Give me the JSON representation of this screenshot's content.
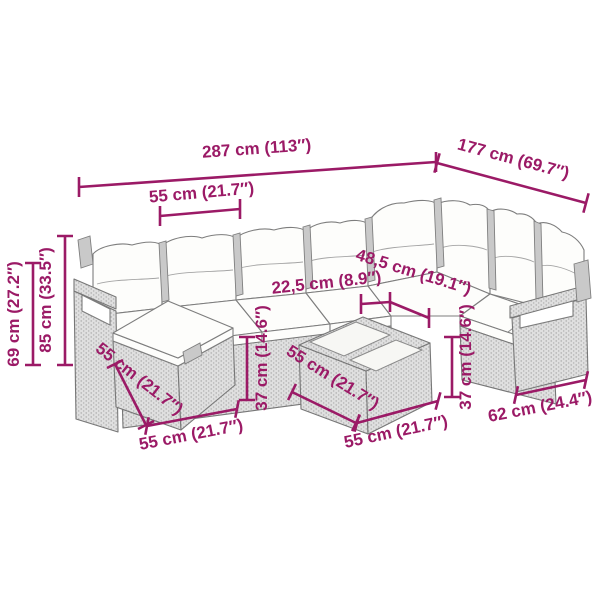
{
  "page": {
    "background": "#ffffff"
  },
  "colors": {
    "dimension_accent": "#9B1A66",
    "drawing_outline": "#777777",
    "rattan_fill": "#dfdfdf",
    "cushion_fill": "#fdfdfb"
  },
  "diagram": {
    "labels": {
      "total_width": "287 cm (113″)",
      "total_depth": "177 cm (69.7″)",
      "seat_module_width": "55 cm (21.7″)",
      "armrest_height": "69 cm (27.2″)",
      "total_height": "85 cm (33.5″)",
      "armrest_width": "22,5 cm (8.9″)",
      "seat_depth": "48,5 cm (19.1″)",
      "seat_height_left": "37 cm (14.6″)",
      "seat_height_right": "37 cm (14.6″)",
      "footstool_depth": "55 cm (21.7″)",
      "footstool_width": "55 cm (21.7″)",
      "table_depth": "55 cm (21.7″)",
      "table_width": "55 cm (21.7″)",
      "end_module_depth": "62 cm (24.4″)"
    }
  }
}
